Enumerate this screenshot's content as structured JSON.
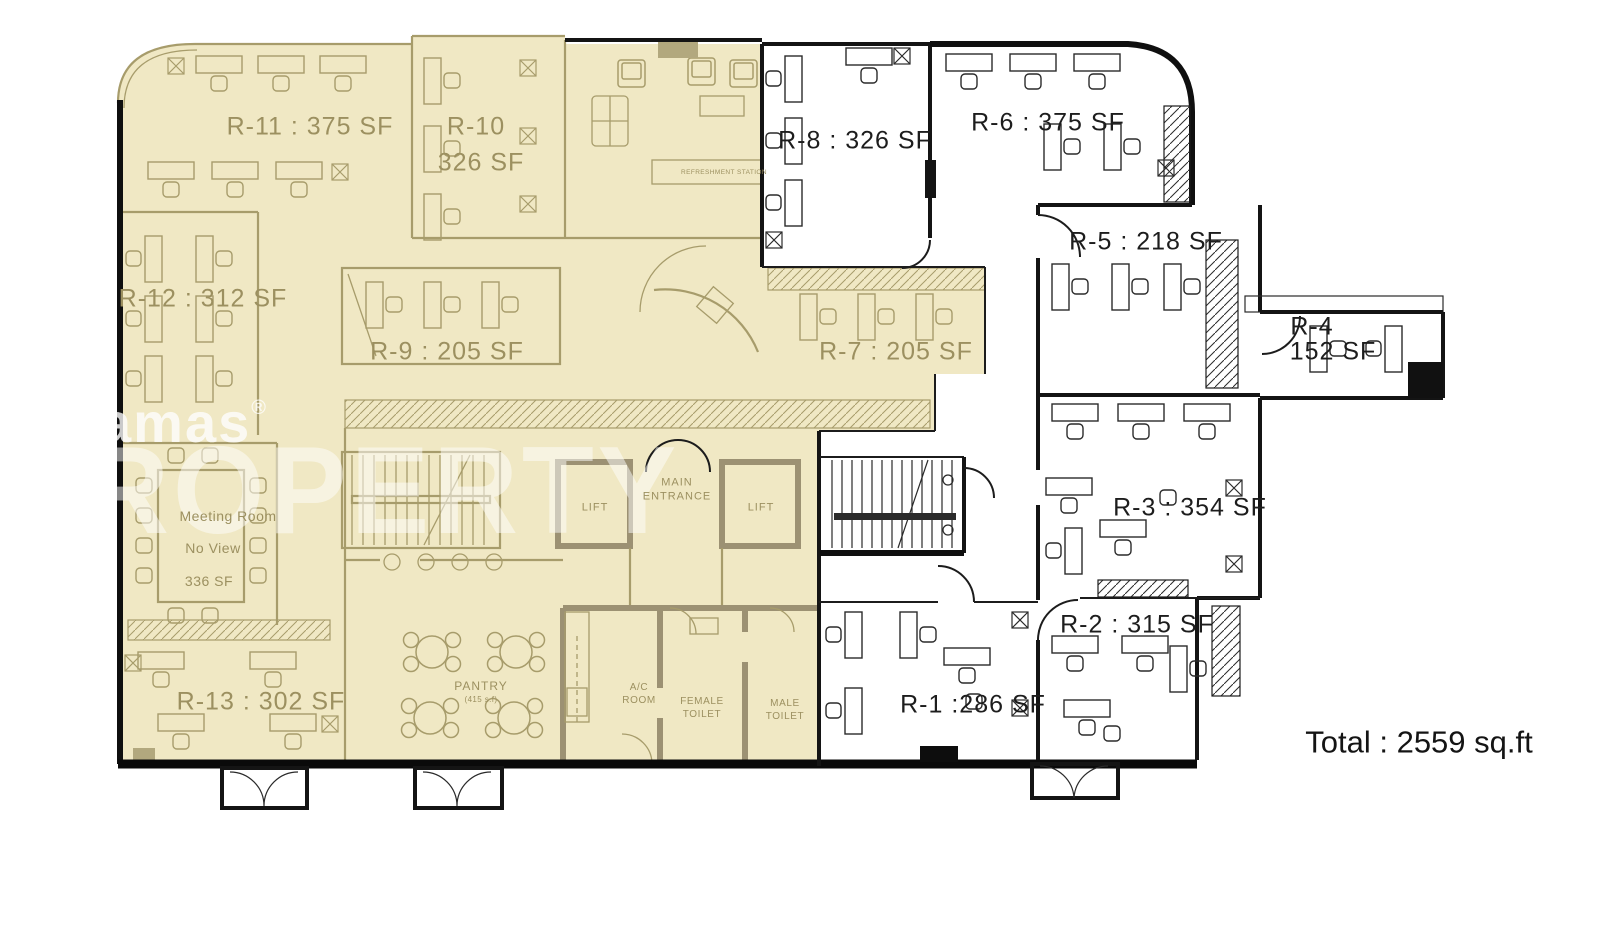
{
  "document": {
    "type": "office-floor-plan"
  },
  "colors": {
    "highlight_fill": "#f0e8c4",
    "plan_line_olive": "#a79c6b",
    "label_olive": "#9c9060",
    "wall_black": "#111111",
    "watermark_white": "#ffffff"
  },
  "rooms": {
    "r1": "R-1 :286 SF",
    "r2": "R-2 : 315 SF",
    "r3": "R-3 : 354 SF",
    "r4_name": "R-4",
    "r4_area": "152 SF",
    "r5": "R-5 : 218 SF",
    "r6": "R-6 : 375 SF",
    "r7": "R-7 : 205 SF",
    "r8": "R-8 : 326 SF",
    "r9": "R-9 : 205 SF",
    "r10_name": "R-10",
    "r10_area": "326 SF",
    "r11": "R-11 : 375 SF",
    "r12": "R-12 : 312 SF",
    "r13": "R-13 : 302 SF"
  },
  "meeting_room": {
    "name": "Meeting Room",
    "view": "No View",
    "area": "336 SF"
  },
  "facilities": {
    "pantry": "PANTRY",
    "pantry_area": "(415 s.f)",
    "ac_room": [
      "A/C",
      "ROOM"
    ],
    "female_toilet": [
      "FEMALE",
      "TOILET"
    ],
    "male_toilet": [
      "MALE",
      "TOILET"
    ],
    "main_entrance": [
      "MAIN",
      "ENTRANCE"
    ],
    "lift": "LIFT",
    "refreshment_station": "REFRESHMENT STATION"
  },
  "summary": {
    "total": "Total : 2559 sq.ft"
  },
  "watermark": {
    "brand": "amas",
    "registered": "®",
    "word": "ROPERTY"
  }
}
